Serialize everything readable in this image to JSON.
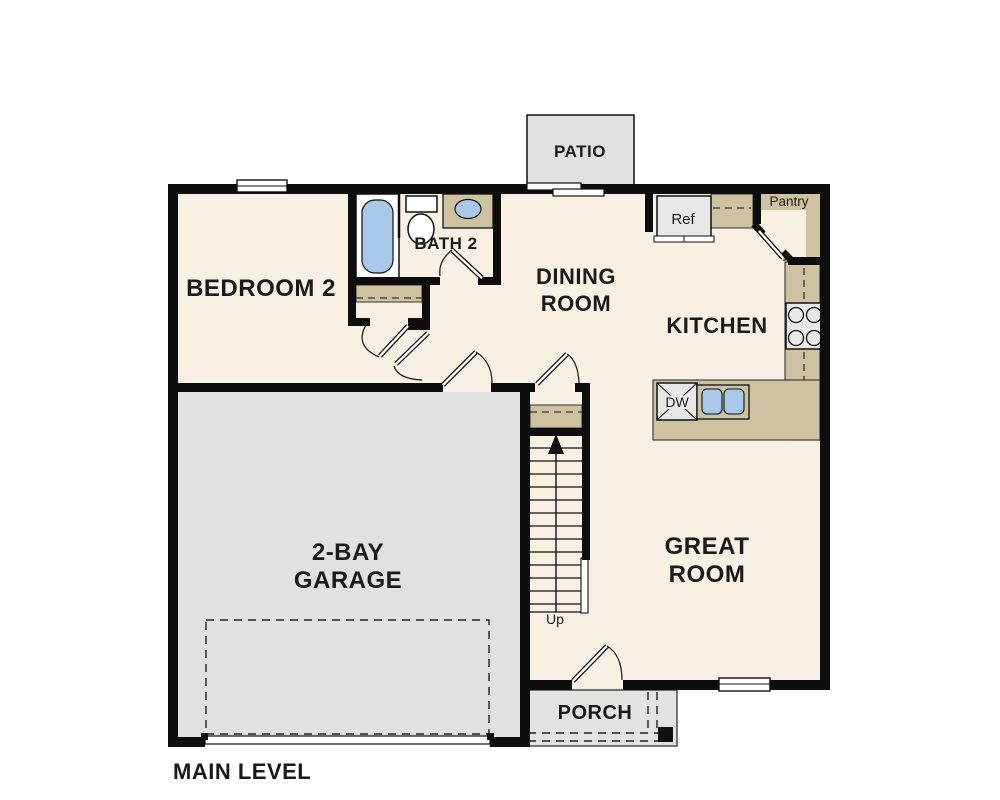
{
  "title": "MAIN LEVEL",
  "rooms": {
    "bedroom2": "BEDROOM 2",
    "bath2": "BATH 2",
    "dining": [
      "DINING",
      "ROOM"
    ],
    "kitchen": "KITCHEN",
    "great": [
      "GREAT",
      "ROOM"
    ],
    "garage": [
      "2-BAY",
      "GARAGE"
    ],
    "patio": "PATIO",
    "porch": "PORCH"
  },
  "labels": {
    "refrigerator": "Ref",
    "pantry": "Pantry",
    "dishwasher": "DW",
    "stairs_direction": "Up"
  },
  "colors": {
    "wall": "#0d0d0d",
    "floor": "#f8f0e2",
    "counter": "#cfc2a1",
    "concrete": "#e1e1e1",
    "appliance": "#e8e8e8",
    "fixture_blue": "#a9c9ea"
  }
}
